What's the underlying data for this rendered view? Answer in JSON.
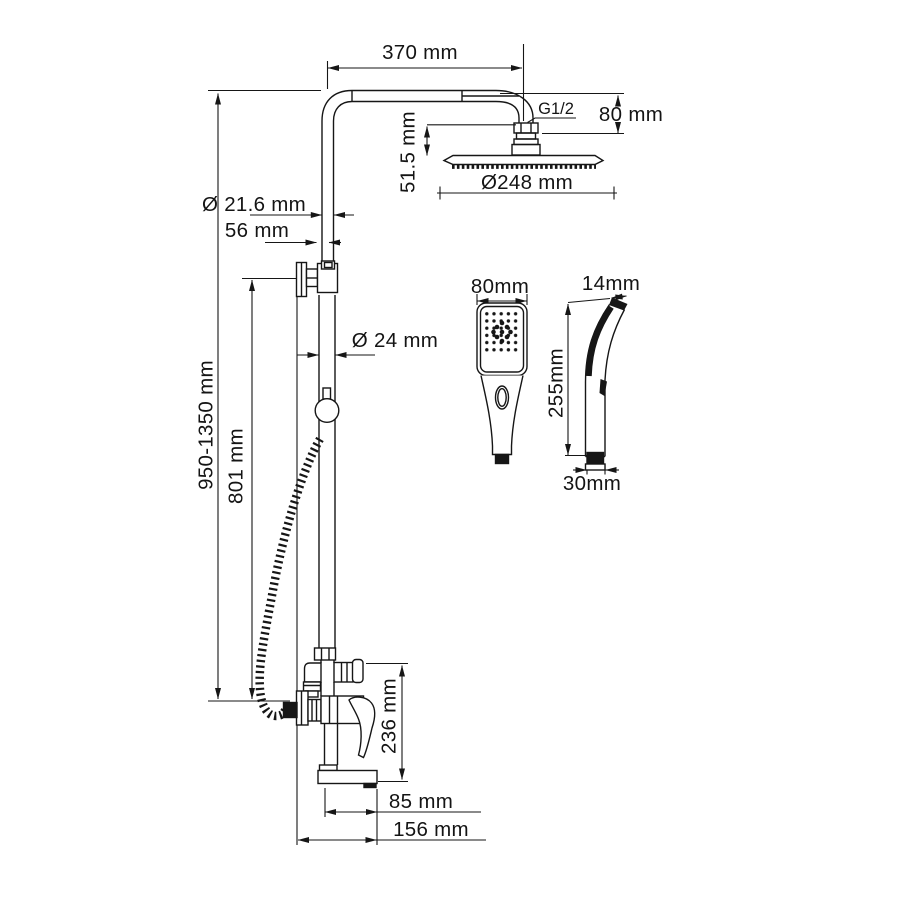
{
  "drawing": {
    "type": "shower-system-dimension-drawing",
    "dimensions": {
      "arm_length": "370 mm",
      "thread_size": "G1/2",
      "head_drop": "80 mm",
      "head_stem_height": "51.5 mm",
      "head_diameter": "Ø248 mm",
      "upper_pipe_diameter": "Ø 21.6 mm",
      "wall_clearance": "56 mm",
      "lower_pipe_diameter": "Ø 24 mm",
      "overall_height": "950-1350 mm",
      "riser_height": "801 mm",
      "handshower_width": "80mm",
      "handshower_top_depth": "14mm",
      "handshower_length": "255mm",
      "handshower_handle_depth": "30mm",
      "mixer_height": "236 mm",
      "spout_reach": "85 mm",
      "total_depth": "156 mm"
    },
    "line_color": "#161616"
  }
}
